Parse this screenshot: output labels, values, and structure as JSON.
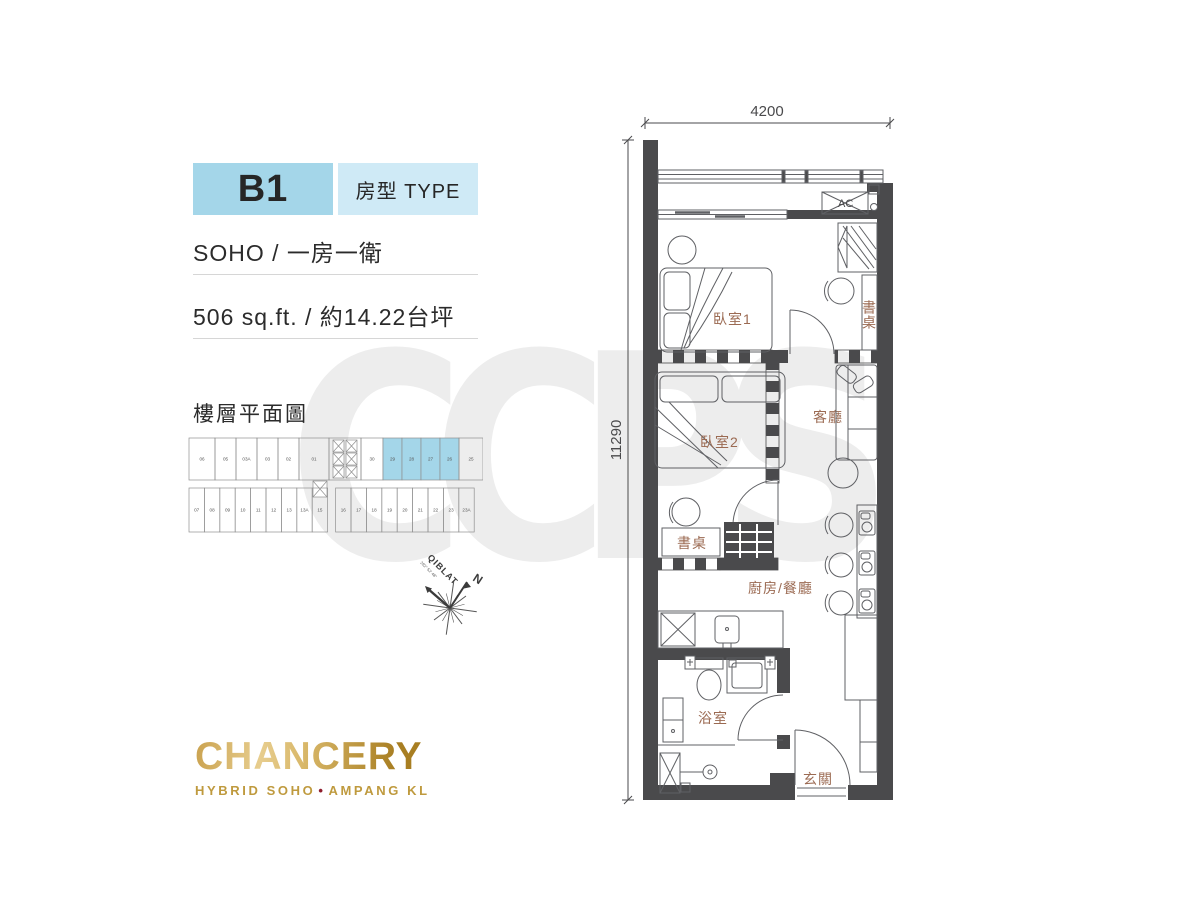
{
  "header": {
    "unit_code": "B1",
    "unit_type_label": "房型 TYPE",
    "layout_text": "SOHO / 一房一衛",
    "area_text": "506 sq.ft. / 約14.22台坪"
  },
  "keyplan": {
    "title": "樓層平面圖",
    "top_units": [
      "06",
      "05",
      "03A",
      "03",
      "02",
      "01",
      "30",
      "29",
      "28",
      "27",
      "26",
      "25"
    ],
    "bottom_units": [
      "07",
      "08",
      "09",
      "10",
      "11",
      "12",
      "13",
      "13A",
      "15",
      "16",
      "17",
      "18",
      "19",
      "20",
      "21",
      "22",
      "23",
      "23A"
    ],
    "highlighted_units": [
      "29",
      "28",
      "27",
      "26"
    ]
  },
  "compass": {
    "north": "N",
    "qiblat": "QIBLAT",
    "qiblat_bearing": "292° 52' 48\""
  },
  "floor_plan": {
    "width_dim": "4200",
    "height_dim": "11290",
    "rooms": {
      "bedroom1": "臥室1",
      "bedroom1_desk": "書桌",
      "bedroom2": "臥室2",
      "living": "客廳",
      "desk": "書桌",
      "kitchen_dining": "廚房/餐廳",
      "bathroom": "浴室",
      "foyer": "玄關",
      "ac_unit": "AC"
    }
  },
  "brand": {
    "name": "CHANCERY",
    "tagline_left": "HYBRID SOHO",
    "tagline_dot": "•",
    "tagline_right": "AMPANG KL"
  },
  "watermark": "CCPS",
  "colors": {
    "accent_blue": "#a4d6e9",
    "accent_blue_light": "#cfeaf6",
    "wall": "#4a4a4c",
    "room_label": "#9b6a52",
    "gold": "#bf9a3e",
    "tagline_dot": "#8e1d2d",
    "watermark_gray": "#ededed"
  }
}
